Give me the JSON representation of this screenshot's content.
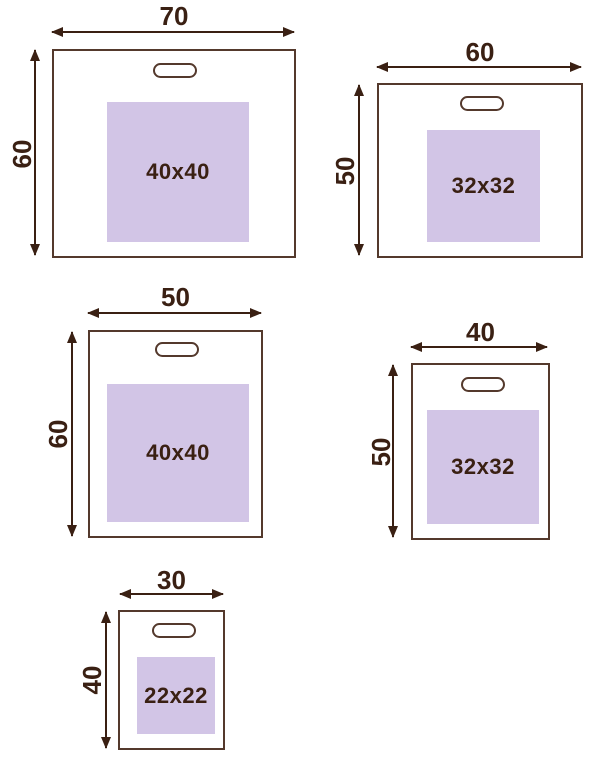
{
  "colors": {
    "ink": "#3a2013",
    "line": "#54392c",
    "print_area_fill": "#d2c5e6",
    "background": "#ffffff"
  },
  "bags": [
    {
      "name": "bag-70x60",
      "width_label": "70",
      "height_label": "60",
      "print_label": "40x40"
    },
    {
      "name": "bag-60x50",
      "width_label": "60",
      "height_label": "50",
      "print_label": "32x32"
    },
    {
      "name": "bag-50x60",
      "width_label": "50",
      "height_label": "60",
      "print_label": "40x40"
    },
    {
      "name": "bag-40x50",
      "width_label": "40",
      "height_label": "50",
      "print_label": "32x32"
    },
    {
      "name": "bag-30x40",
      "width_label": "30",
      "height_label": "40",
      "print_label": "22x22"
    }
  ]
}
